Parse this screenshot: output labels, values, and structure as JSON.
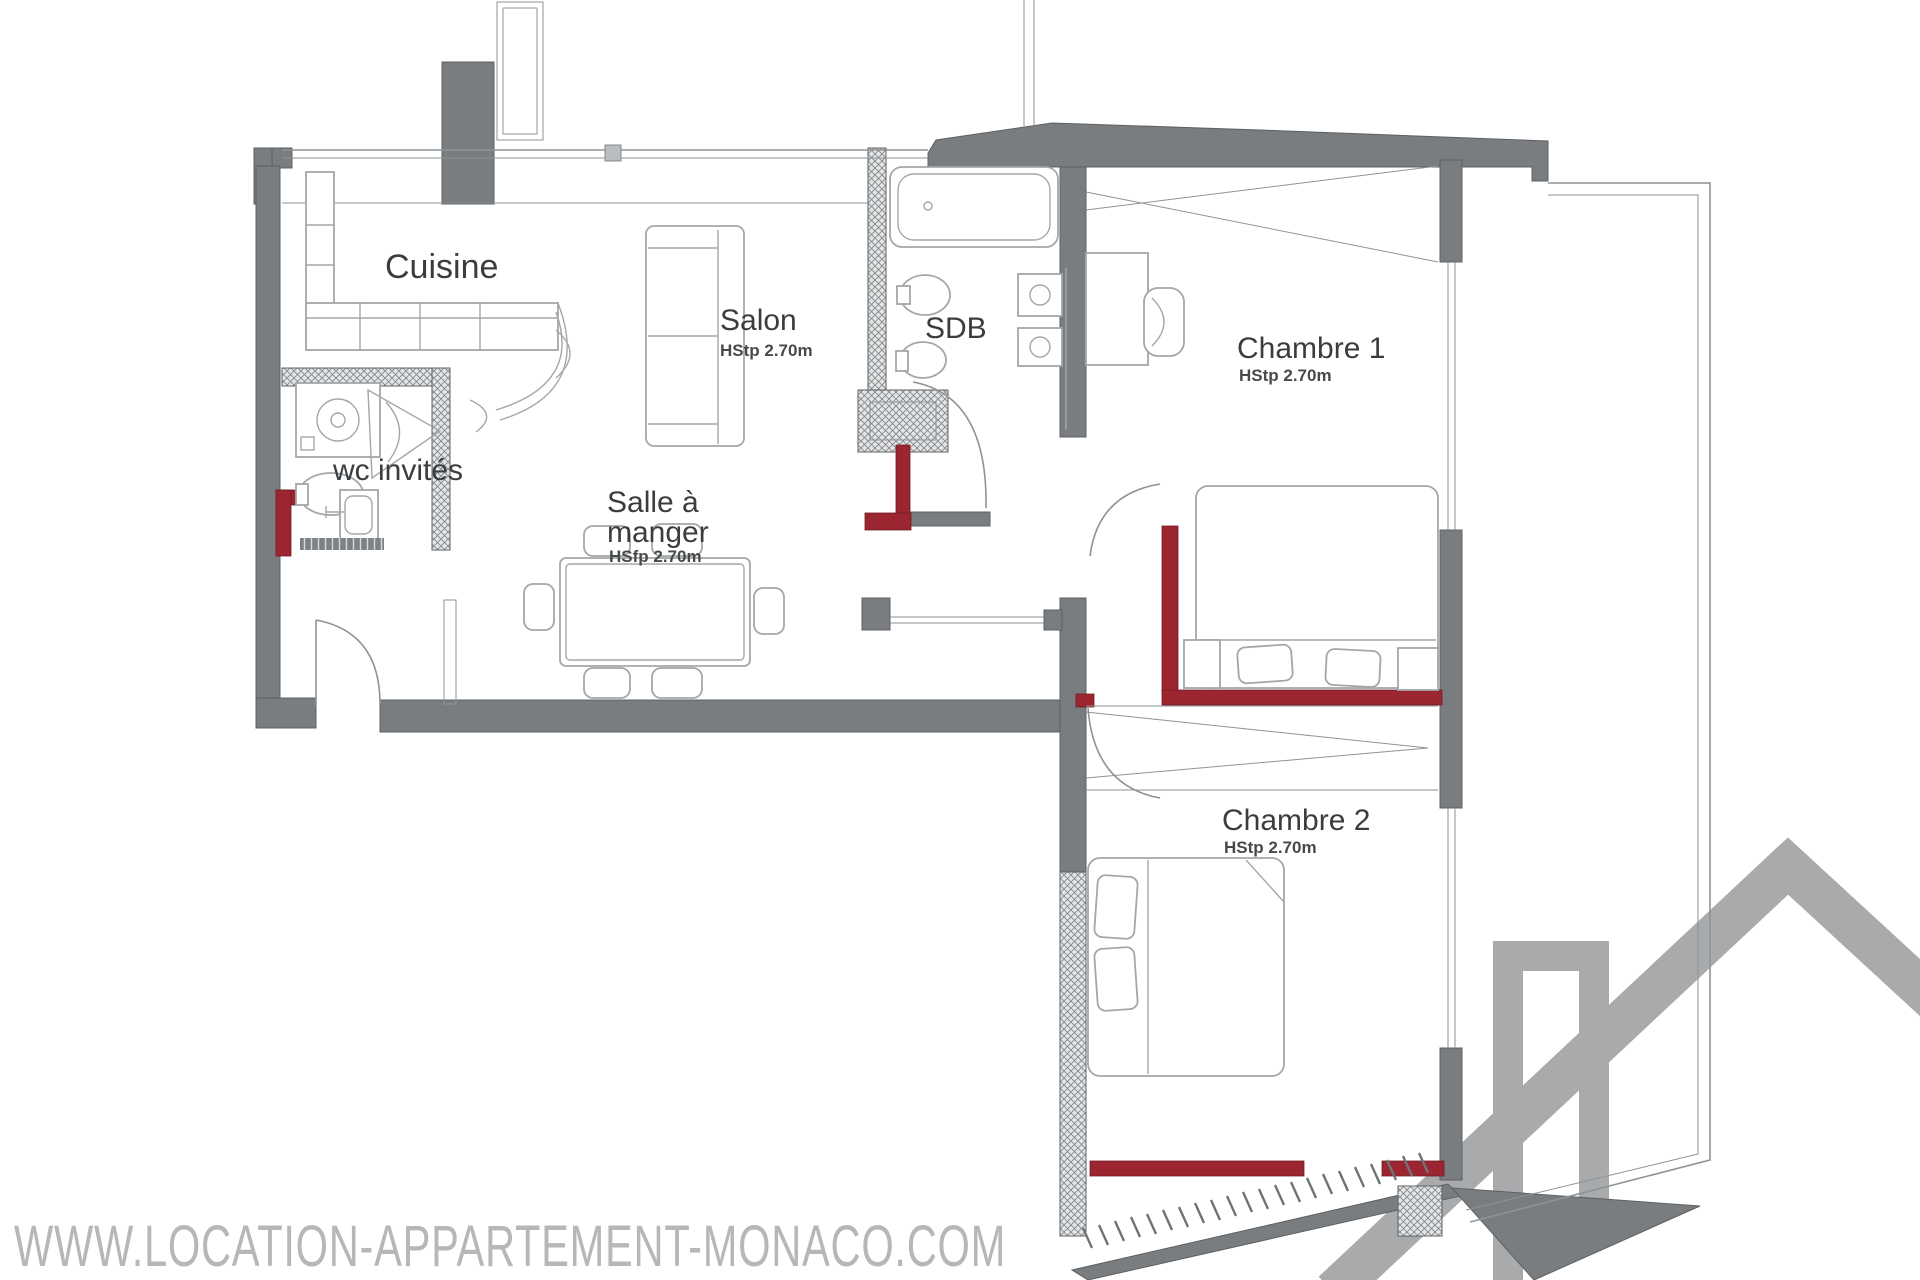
{
  "page": {
    "type": "apartment-floor-plan"
  },
  "rooms": {
    "cuisine": {
      "label": "Cuisine"
    },
    "salon": {
      "label": "Salon",
      "height": "HStp 2.70m"
    },
    "sdb": {
      "label": "SDB"
    },
    "wc_invites": {
      "label": "wc invités"
    },
    "salle_a_manger": {
      "label_line1": "Salle à",
      "label_line2": "manger",
      "height": "HSfp 2.70m"
    },
    "chambre1": {
      "label": "Chambre 1",
      "height": "HStp 2.70m"
    },
    "chambre2": {
      "label": "Chambre 2",
      "height": "HStp 2.70m"
    }
  },
  "watermark": {
    "url_text": "WWW.LOCATION-APPARTEMENT-MONACO.COM"
  },
  "colors": {
    "wall_gray": "#797d80",
    "wall_dark": "#5d6063",
    "outline_gray": "#8e9396",
    "furniture_gray": "#a3a7aa",
    "hatch_bg": "#e3e5e6",
    "hatch_line": "#84888b",
    "accent_red": "#9b2631",
    "label_text": "#3a3d3f",
    "sub_text": "#47494b",
    "watermark_gray": "#b5b7b9",
    "logo_gray": "#a8aaac"
  }
}
